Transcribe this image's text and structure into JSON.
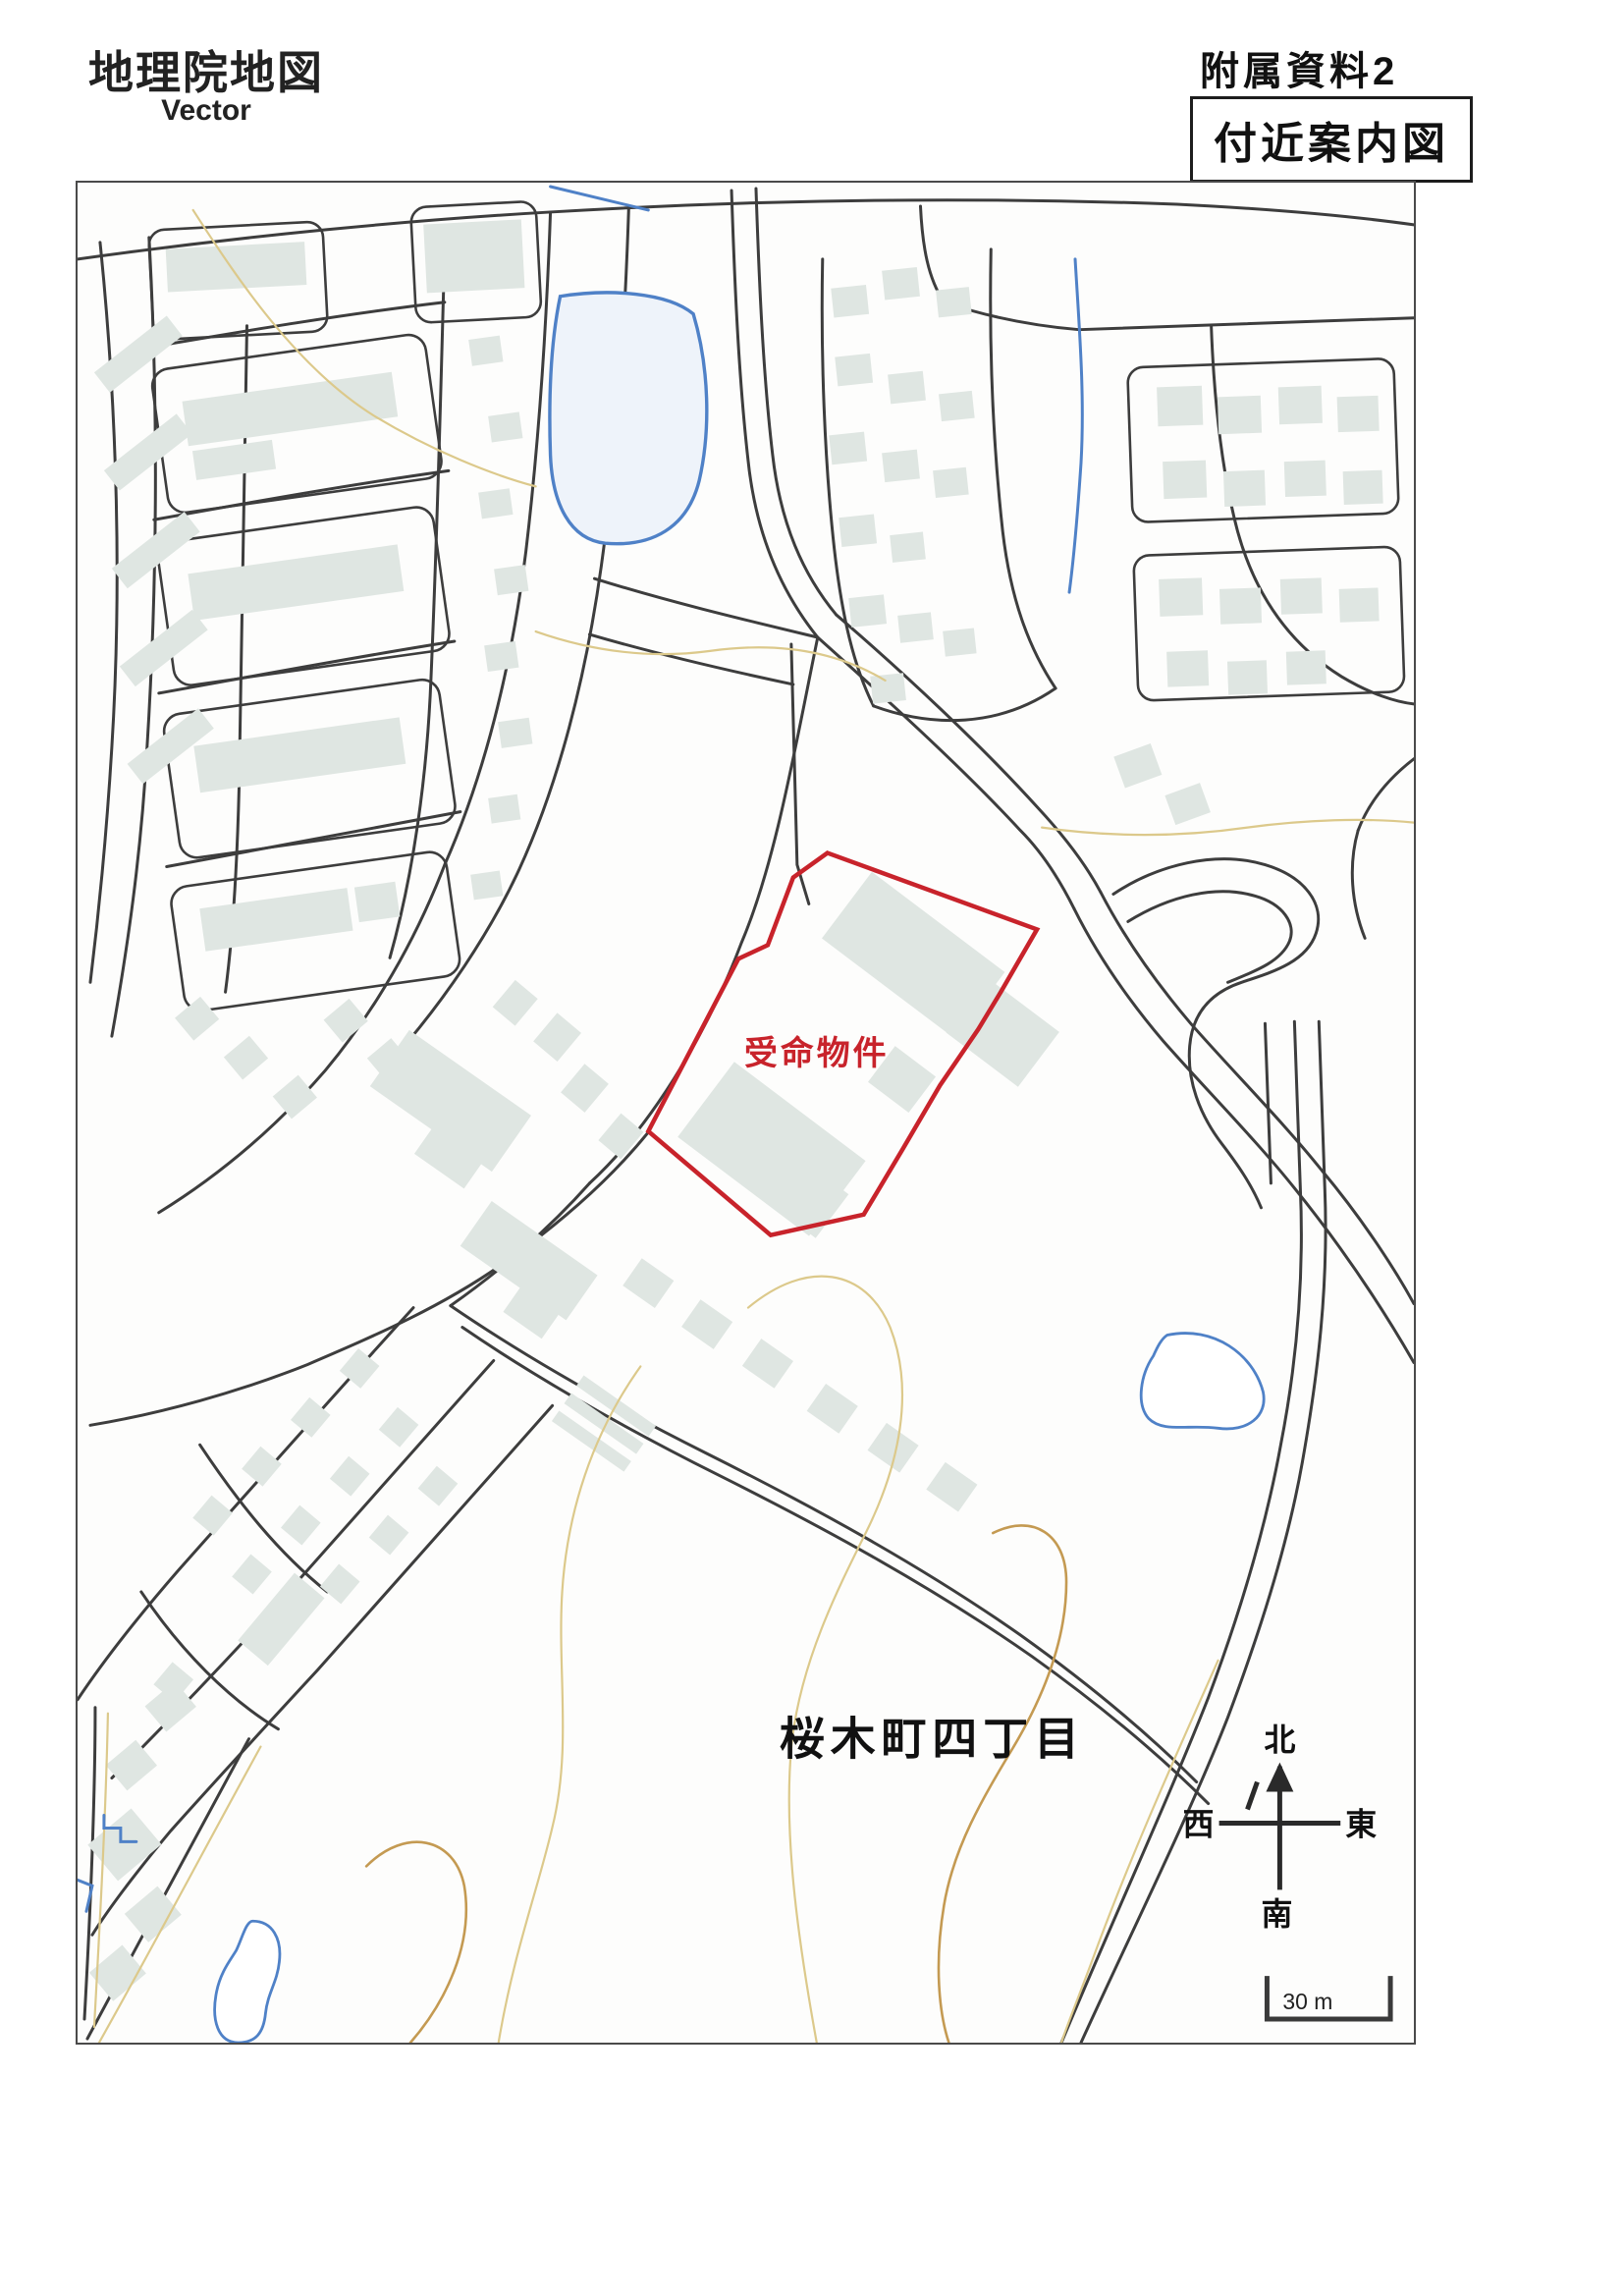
{
  "header": {
    "title_main": "地理院地図",
    "title_sub": "Vector",
    "doc_label": "附属資料2",
    "map_box_label": "付近案内図"
  },
  "map": {
    "site_label": "受命物件",
    "district_label": "桜木町四丁目",
    "compass": {
      "north": "北",
      "south": "南",
      "east": "東",
      "west": "西"
    },
    "scale_label": "30 m"
  },
  "colors": {
    "road": "#3d3d3d",
    "building": "#dfe6e2",
    "water": "#4f81c7",
    "contour": "#dcc98b",
    "contour_dark": "#c49a52",
    "site_outline": "#c8232b",
    "frame": "#4a4a4a",
    "text": "#1a1a1a"
  }
}
